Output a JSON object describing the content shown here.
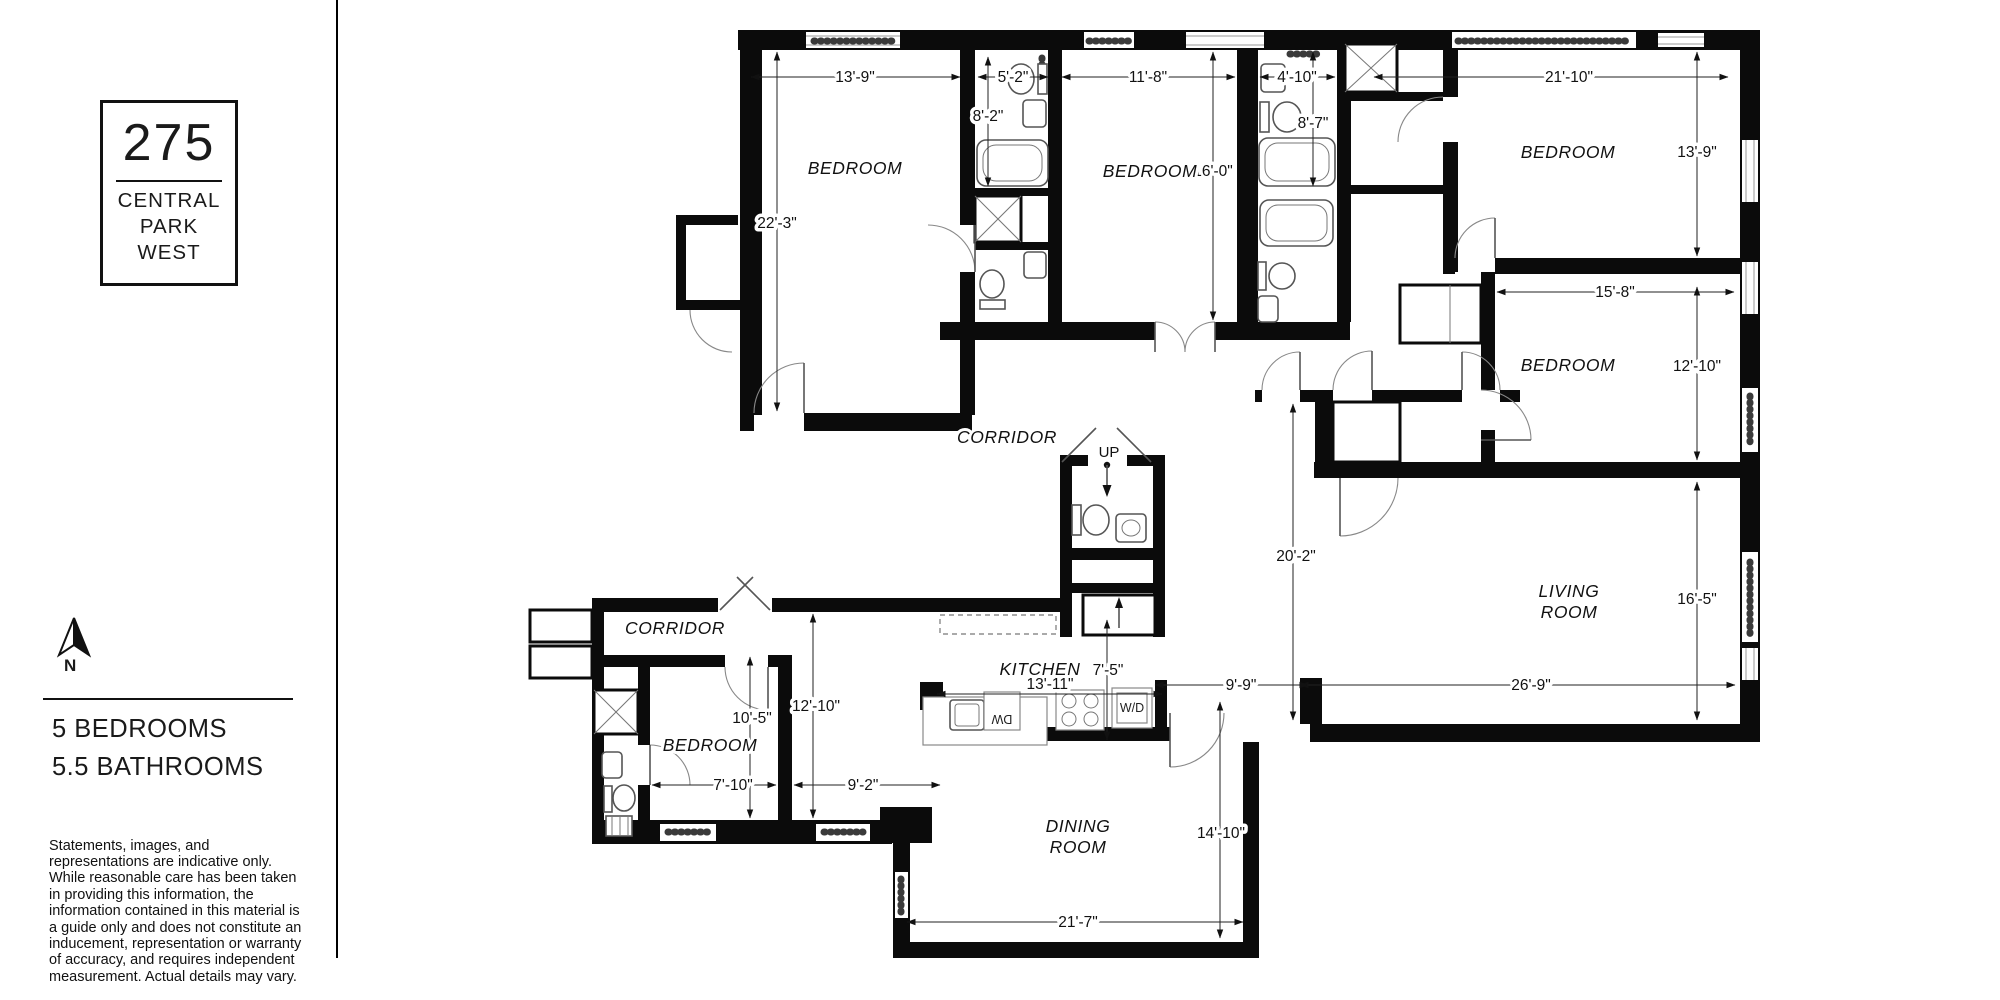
{
  "sidebar": {
    "logo": {
      "number": "275",
      "name_line1": "CENTRAL",
      "name_line2": "PARK",
      "name_line3": "WEST"
    },
    "compass": {
      "label": "N"
    },
    "summary": {
      "bedrooms": "5 BEDROOMS",
      "bathrooms": "5.5 BATHROOMS"
    },
    "disclaimer": "Statements, images, and representations are indicative only. While reasonable care has been taken in providing this information, the information contained in this material is a guide only and does not constitute an inducement, representation or warranty of accuracy, and requires independent measurement. Actual details may vary."
  },
  "floorplan": {
    "rooms": {
      "bedroom": "BEDROOM",
      "living_line1": "LIVING",
      "living_line2": "ROOM",
      "dining_line1": "DINING",
      "dining_line2": "ROOM",
      "kitchen": "KITCHEN",
      "corridor": "CORRIDOR",
      "stairs_up": "UP"
    },
    "appliances": {
      "washer_dryer": "W/D",
      "dishwasher": "DW"
    },
    "dimensions": {
      "bedroom_tl_width": "13'-9\"",
      "bedroom_tl_height": "22'-3\"",
      "bath1_width": "5'-2\"",
      "bath1_height": "8'-2\"",
      "bedroom_tm_width": "11'-8\"",
      "bedroom_tm_height": "16'-0\"",
      "bath2_width": "4'-10\"",
      "bath2_height": "8'-7\"",
      "bedroom_tr_width": "21'-10\"",
      "bedroom_tr_height": "13'-9\"",
      "bedroom_mr_width": "15'-8\"",
      "bedroom_mr_height": "12'-10\"",
      "hall_height": "20'-2\"",
      "living_height": "16'-5\"",
      "living_width": "26'-9\"",
      "hall_width": "9'-9\"",
      "kitchen_depth": "7'-5\"",
      "kitchen_width": "13'-11\"",
      "bedroom_bl_height": "10'-5\"",
      "foyer_height": "12'-10\"",
      "bedroom_bl_width": "7'-10\"",
      "foyer_width": "9'-2\"",
      "dining_height": "14'-10\"",
      "dining_width": "21'-7\""
    }
  }
}
